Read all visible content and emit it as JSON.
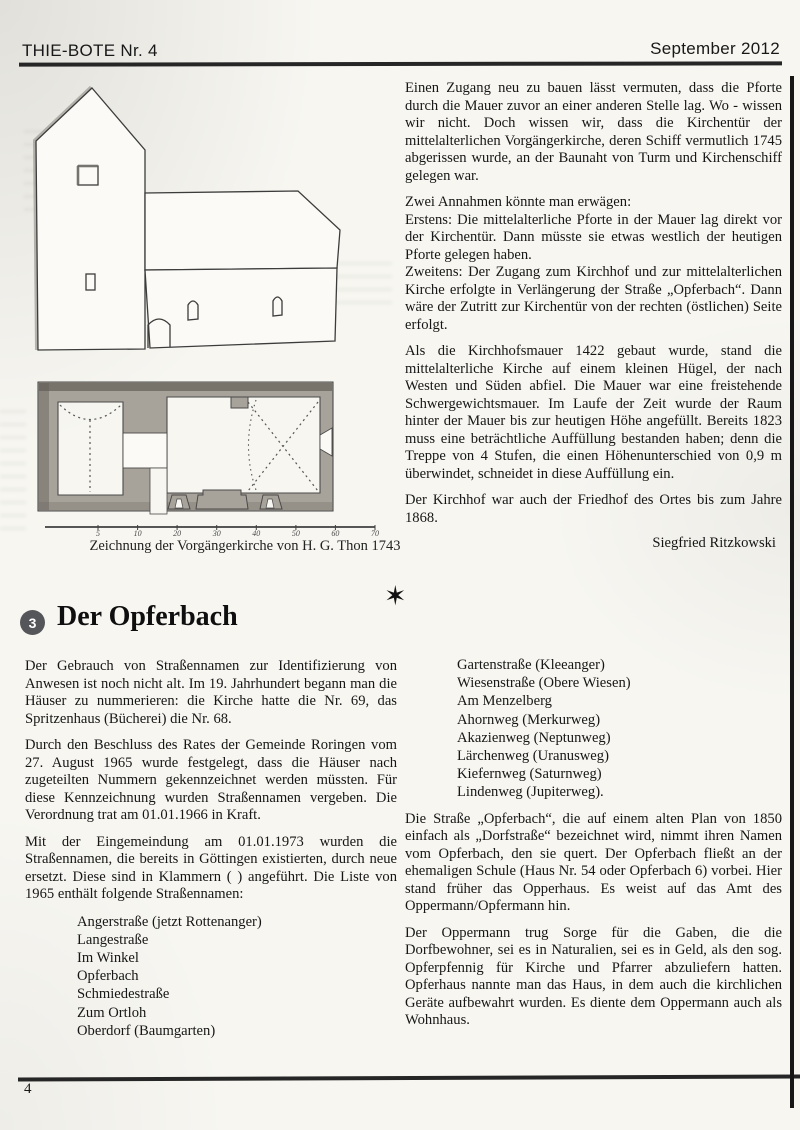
{
  "header": {
    "title": "THIE-BOTE Nr. 4",
    "date": "September 2012"
  },
  "icons": {
    "star": "✶"
  },
  "figure": {
    "caption": "Zeichnung der Vorgängerkirche von H. G. Thon 1743",
    "scale_labels": [
      "5",
      "10",
      "20",
      "30",
      "40",
      "50",
      "60",
      "70"
    ]
  },
  "kirchhof": {
    "p1": "Einen Zugang neu zu bauen lässt vermuten, dass die Pforte durch die Mauer zuvor an einer anderen Stelle lag. Wo - wissen wir nicht. Doch wissen wir, dass die Kirchentür der mittelalterlichen Vorgängerkirche, deren Schiff vermutlich 1745 abgerissen wurde, an der Baunaht von Turm und Kirchenschiff gelegen war.",
    "annahmen_intro": "Zwei Annahmen könnte man erwägen:",
    "annahmen_erstens": "Erstens: Die mittelalterliche Pforte in der Mauer lag direkt vor der Kirchentür. Dann müsste sie etwas westlich der heutigen Pforte gelegen haben.",
    "annahmen_zweitens": "Zweitens: Der Zugang zum Kirchhof und zur mittelalterlichen Kirche erfolgte in Verlängerung der Straße „Opferbach“. Dann wäre der Zutritt zur Kirchentür von der rechten (östlichen) Seite erfolgt.",
    "p3": "Als die Kirchhofsmauer 1422 gebaut wurde, stand die mittelalterliche Kirche auf einem kleinen Hügel, der nach Westen und Süden abfiel. Die Mauer war eine freistehende Schwergewichtsmauer. Im Laufe der Zeit wurde der Raum hinter der Mauer bis zur heutigen Höhe angefüllt. Bereits 1823 muss eine beträchtliche Auffüllung bestanden haben; denn die Treppe von 4 Stufen, die einen Höhenunterschied von 0,9 m überwindet, schneidet in diese Auffüllung ein.",
    "p4": "Der Kirchhof war auch der Friedhof des Ortes bis zum Jahre 1868.",
    "signature": "Siegfried Ritzkowski"
  },
  "opferbach": {
    "number": "3",
    "title": "Der Opferbach",
    "p1": "Der Gebrauch von Straßennamen zur Identifizierung von Anwesen ist noch nicht alt. Im 19. Jahrhundert begann man die Häuser zu nummerieren: die Kirche hatte die Nr. 69, das Spritzenhaus (Bücherei) die Nr. 68.",
    "p2": "Durch den Beschluss des Rates der Gemeinde Roringen vom 27. August 1965 wurde festgelegt, dass die Häuser nach zugeteilten Nummern gekennzeichnet werden müssten. Für diese Kennzeichnung wurden Straßennamen vergeben. Die Verordnung trat am 01.01.1966 in Kraft.",
    "p3": "Mit der Eingemeindung am 01.01.1973 wurden die Straßennamen, die bereits in Göttingen existierten, durch neue ersetzt. Diese sind in Klammern ( ) angeführt. Die Liste von 1965 enthält folgende Straßennamen:",
    "streets_left": [
      "Angerstraße (jetzt Rottenanger)",
      "Langestraße",
      "Im Winkel",
      "Opferbach",
      "Schmiedestraße",
      "Zum Ortloh",
      "Oberdorf (Baumgarten)"
    ],
    "streets_right": [
      "Gartenstraße (Kleeanger)",
      "Wiesenstraße (Obere Wiesen)",
      "Am Menzelberg",
      "Ahornweg (Merkurweg)",
      "Akazienweg (Neptunweg)",
      "Lärchenweg (Uranusweg)",
      "Kiefernweg (Saturnweg)",
      "Lindenweg (Jupiterweg)."
    ],
    "p4": "Die Straße „Opferbach“, die auf einem alten Plan von 1850 einfach als „Dorfstraße“ bezeichnet wird, nimmt ihren Namen vom Opferbach, den sie quert. Der Opferbach fließt an der ehemaligen Schule (Haus Nr. 54 oder Opferbach 6) vorbei. Hier stand früher das Opperhaus. Es weist auf das Amt des Oppermann/Opfermann hin.",
    "p5": "Der Oppermann trug Sorge für die Gaben, die die Dorfbewohner, sei es in Naturalien, sei es in Geld, als den sog. Opferpfennig für Kirche und Pfarrer abzuliefern hatten. Opferhaus nannte man das Haus, in dem auch die kirchlichen Geräte aufbewahrt wurden. Es diente dem Oppermann auch als Wohnhaus."
  },
  "footer": {
    "page": "4"
  }
}
